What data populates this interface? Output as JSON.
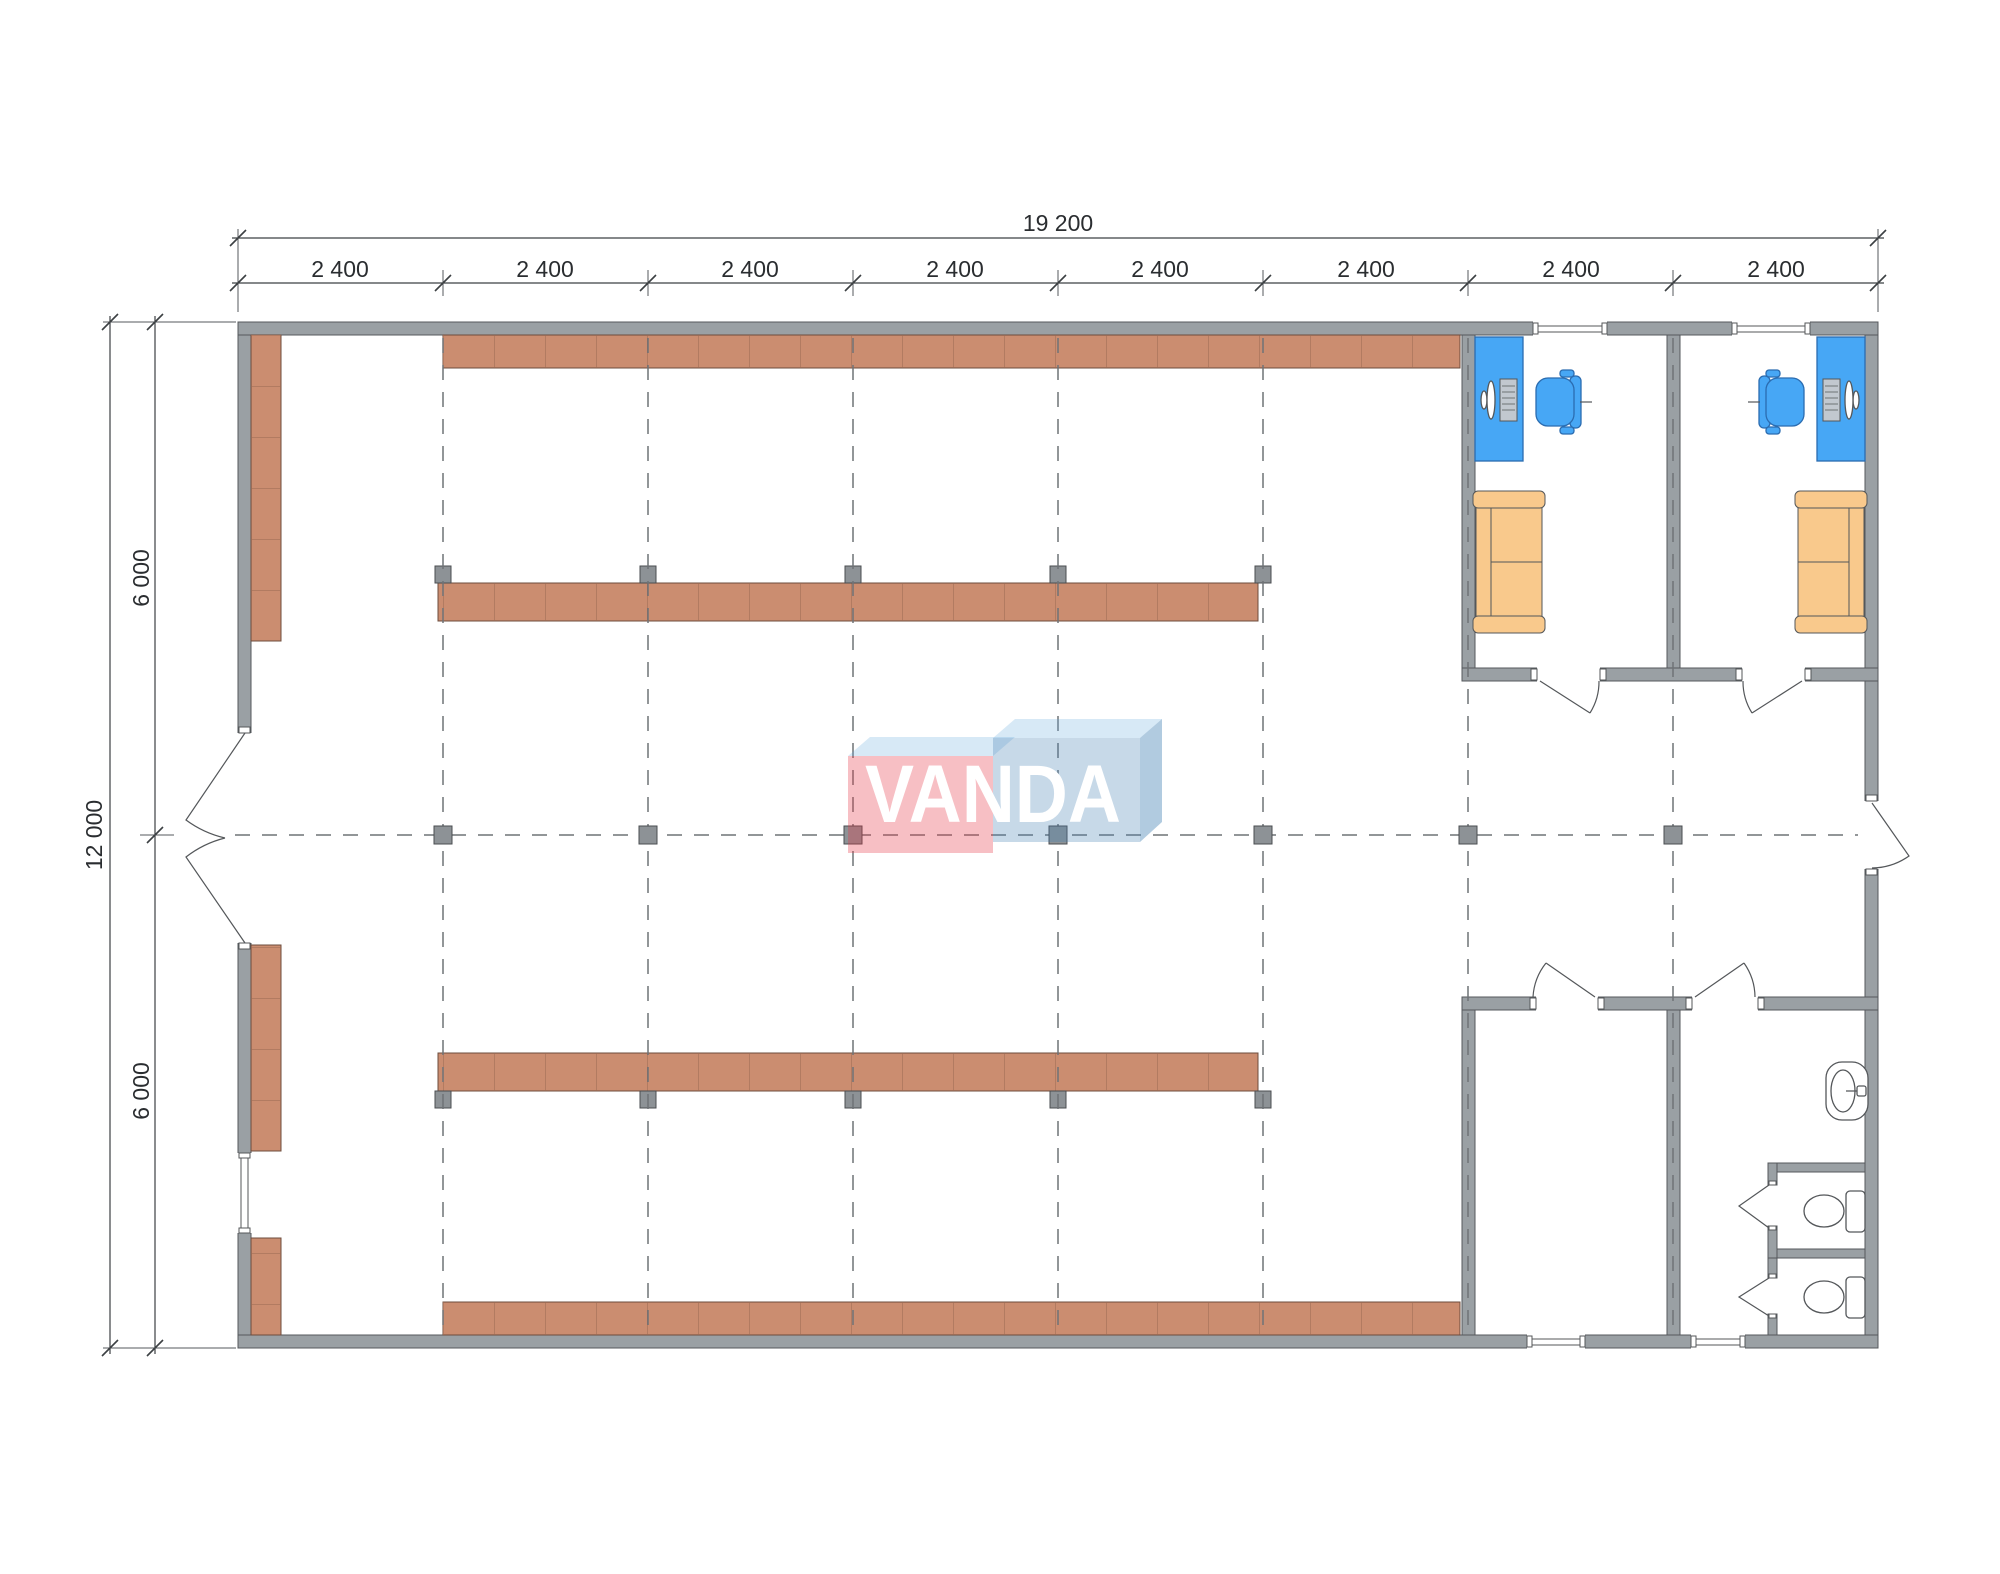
{
  "dimensions": {
    "total_width": "19 200",
    "bays": [
      "2 400",
      "2 400",
      "2 400",
      "2 400",
      "2 400",
      "2 400",
      "2 400",
      "2 400"
    ],
    "total_height": "12 000",
    "height_halves": [
      "6 000",
      "6 000"
    ]
  },
  "watermark": {
    "text": "VANDA",
    "pink": "#E63946",
    "blue": "#4682B4",
    "top_face": "#64AADC"
  },
  "colors": {
    "wall": "#9aa0a4",
    "wall_outline": "#55585c",
    "shelf": "#cb8d70",
    "shelf_divider": "#9a6952",
    "column": "#8d9296",
    "desk": "#47a7f5",
    "chair": "#47a7f5",
    "sofa": "#f9c98c",
    "grid_line": "#6f7377",
    "dimension_text": "#2a2d30"
  },
  "elements": [
    "exterior-wall",
    "interior-wall",
    "window",
    "entrance-double-door",
    "door-swing",
    "shelving-unit",
    "structural-column",
    "grid-line",
    "desk",
    "computer",
    "office-chair",
    "sofa",
    "sink",
    "toilet",
    "toilet-stall"
  ]
}
